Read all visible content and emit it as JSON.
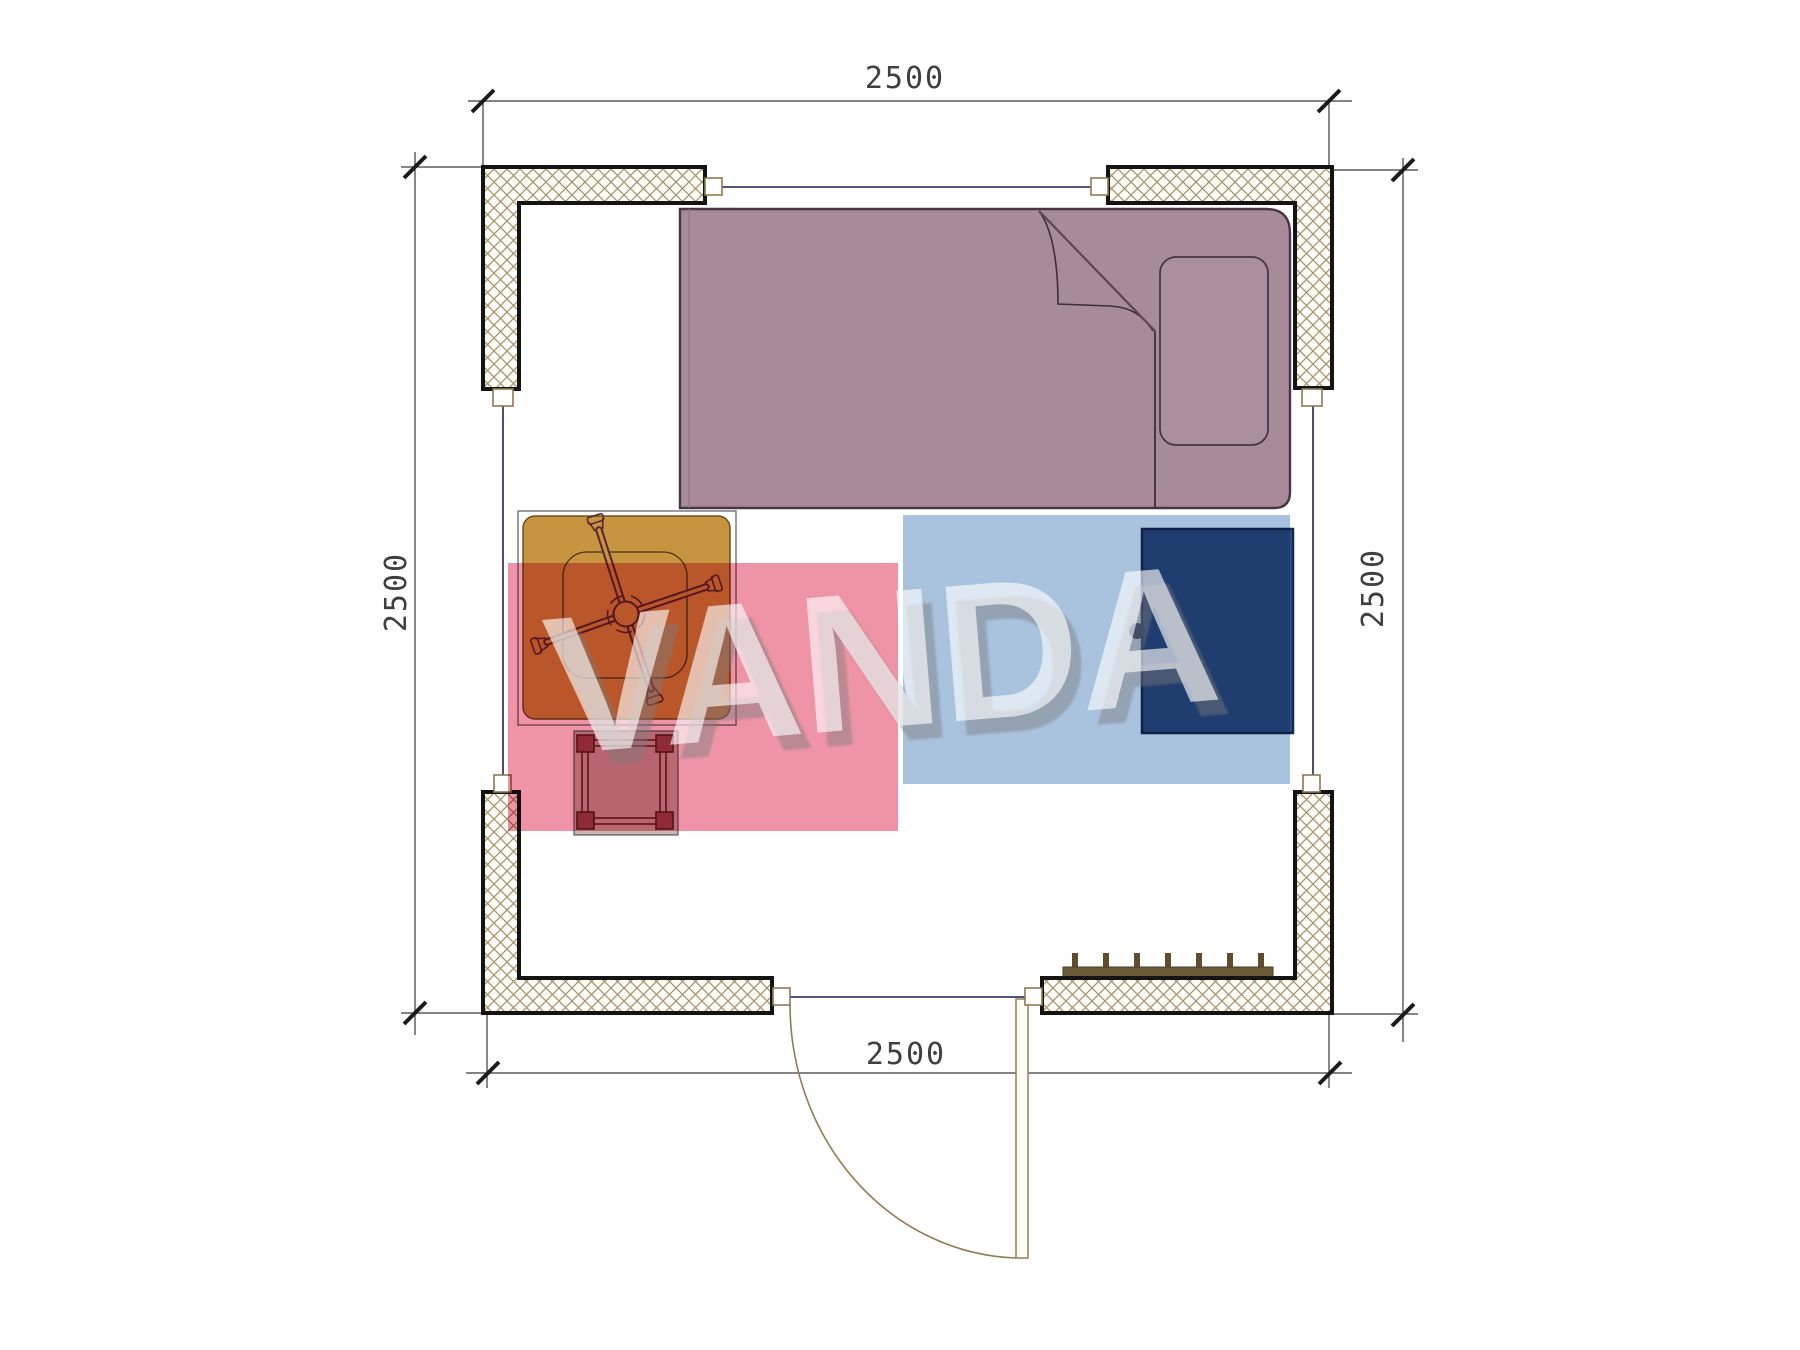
{
  "page": {
    "type": "architectural-floor-plan",
    "background": "#ffffff"
  },
  "watermark": {
    "text": "VANDA",
    "pink_color": "#ee94a6",
    "blue_color": "#a9c2de",
    "text_color": "rgba(255,255,255,0.62)"
  },
  "dimensions": {
    "top": "2500",
    "bottom": "2500",
    "left": "2500",
    "right": "2500"
  },
  "furniture_items": [
    "bed",
    "pillow",
    "blanket-fold",
    "desk-table",
    "office-chair",
    "stool",
    "wardrobe",
    "radiator",
    "door"
  ],
  "colors": {
    "bed_fill": "#a78b9b",
    "bed_outline": "#4a3547",
    "table_fill": "#c79540",
    "wardrobe_fill": "#30507f",
    "wardrobe_knob": "#1c3464",
    "stool_frame": "#6e2f38",
    "stool_seat": "#c9b6b1",
    "radiator": "#6b5b38",
    "wall_border": "#141414",
    "wall_hatch_line": "#a2906b",
    "window_line": "#3c3c64",
    "dimension_line": "#3a3a3a",
    "door_arc": "#8f7d55"
  }
}
